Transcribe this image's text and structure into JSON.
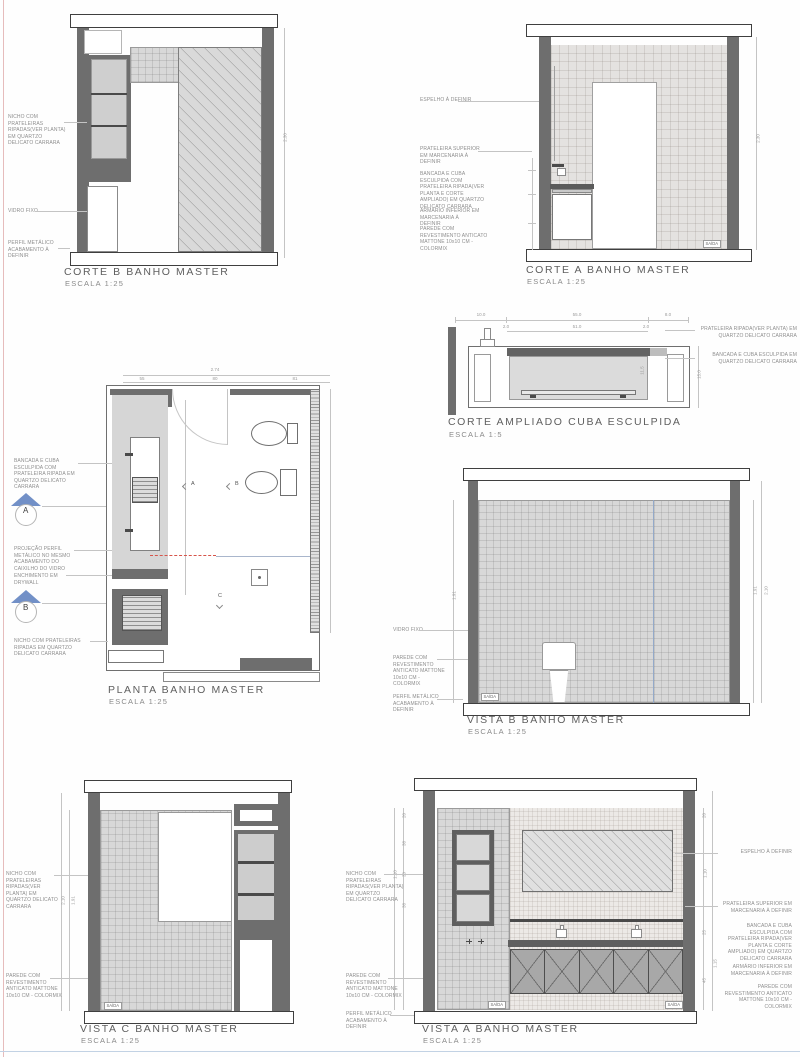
{
  "labels": {
    "exit": "SAÍDA"
  },
  "colors": {
    "wall_dark": "#6e6e6e",
    "tile_fill": "#d8d8d8",
    "accent_blue": "#7290c7",
    "accent_red": "#d6544a",
    "line_gray": "#c4c4c4",
    "text_gray": "#8e8e8e"
  },
  "panels": {
    "corte_b": {
      "title": "CORTE B BANHO MASTER",
      "scale": "ESCALA 1:25",
      "annotations": [
        "NICHO COM PRATELEIRAS RIPADAS(VER PLANTA) EM QUARTZO DELICATO CARRARA",
        "VIDRO FIXO",
        "PERFIL METÁLICO ACABAMENTO À DEFINIR"
      ],
      "dim_right": "2.30"
    },
    "corte_a": {
      "title": "CORTE A BANHO MASTER",
      "scale": "ESCALA 1:25",
      "annotations": [
        "ESPELHO À DEFINIR",
        "PRATELEIRA SUPERIOR EM MARCENARIA À DEFINIR",
        "BANCADA E CUBA ESCULPIDA COM PRATELEIRA RIPADA(VER PLANTA E CORTE AMPLIADO) EM QUARTZO DELICATO CARRARA",
        "ARMÁRIO INFERIOR EM MARCENARIA À DEFINIR",
        "PAREDE COM REVESTIMENTO ANTICATO MATTONE 10x10 CM - COLORMIX"
      ],
      "dim_right": "2.30"
    },
    "corte_ampliado": {
      "title": "CORTE AMPLIADO CUBA ESCULPIDA",
      "scale": "ESCALA 1:5",
      "annotations": [
        "PRATELEIRA RIPADA(VER PLANTA) EM QUARTZO DELICATO CARRARA",
        "BANCADA E CUBA ESCULPIDA EM QUARTZO DELICATO CARRARA"
      ],
      "dims_top": [
        "10.0",
        "55.0",
        "8.0"
      ],
      "dims_inner": [
        "2.0",
        "51.0",
        "2.0"
      ],
      "dim_height": "15.0",
      "dim_basin": "11.5"
    },
    "planta": {
      "title": "PLANTA BANHO MASTER",
      "scale": "ESCALA 1:25",
      "annotations": [
        "BANCADA E CUBA ESCULPIDA COM PRATELEIRA RIPADA EM QUARTZO DELICATO CARRARA",
        "PROJEÇÃO PERFIL METÁLICO NO MESMO ACABAMENTO DO CAIXILHO DO VIDRO",
        "ENCHIMENTO EM DRYWALL",
        "NICHO COM PRATELEIRAS RIPADAS EM QUARTZO DELICATO CARRARA"
      ],
      "markers": {
        "section_a": "A",
        "section_b": "B",
        "view_a": "A",
        "view_b": "B",
        "view_c": "C"
      },
      "dim_total": "2.74",
      "dims_top": [
        "55",
        "80",
        "81"
      ]
    },
    "vista_b": {
      "title": "VISTA B BANHO MASTER",
      "scale": "ESCALA 1:25",
      "annotations": [
        "VIDRO FIXO",
        "PAREDE COM REVESTIMENTO ANTICATO MATTONE 10x10 CM - COLORMIX",
        "PERFIL METÁLICO ACABAMENTO À DEFINIR"
      ],
      "dim_left": "1.91",
      "dims_right": [
        "1.91",
        "2.10"
      ]
    },
    "vista_c": {
      "title": "VISTA C BANHO MASTER",
      "scale": "ESCALA 1:25",
      "annotations": [
        "NICHO COM PRATELEIRAS RIPADAS(VER PLANTA) EM QUARTZO DELICATO CARRARA",
        "PAREDE COM REVESTIMENTO ANTICATO MATTONE 10x10 CM - COLORMIX"
      ],
      "dims_left": [
        "1.91",
        "2.10"
      ]
    },
    "vista_a": {
      "title": "VISTA A BANHO MASTER",
      "scale": "ESCALA 1:25",
      "annotations_left": [
        "NICHO COM PRATELEIRAS RIPADAS(VER PLANTA) EM QUARTZO DELICATO CARRARA",
        "PAREDE COM REVESTIMENTO ANTICATO MATTONE 10x10 CM - COLORMIX",
        "PERFIL METÁLICO ACABAMENTO À DEFINIR"
      ],
      "annotations_right": [
        "ESPELHO À DEFINIR",
        "PRATELEIRA SUPERIOR EM MARCENARIA À DEFINIR",
        "BANCADA E CUBA ESCULPIDA COM PRATELEIRA RIPADA(VER PLANTA E CORTE AMPLIADO) EM QUARTZO DELICATO CARRARA",
        "ARMÁRIO INFERIOR EM MARCENARIA À DEFINIR",
        "PAREDE COM REVESTIMENTO ANTICATO MATTONE 10x10 CM - COLORMIX"
      ],
      "dims_left": [
        "20",
        "38",
        "30",
        "38",
        "1.10"
      ],
      "dims_right": [
        "20",
        "1.10",
        "25",
        "1.15",
        "45"
      ]
    }
  }
}
